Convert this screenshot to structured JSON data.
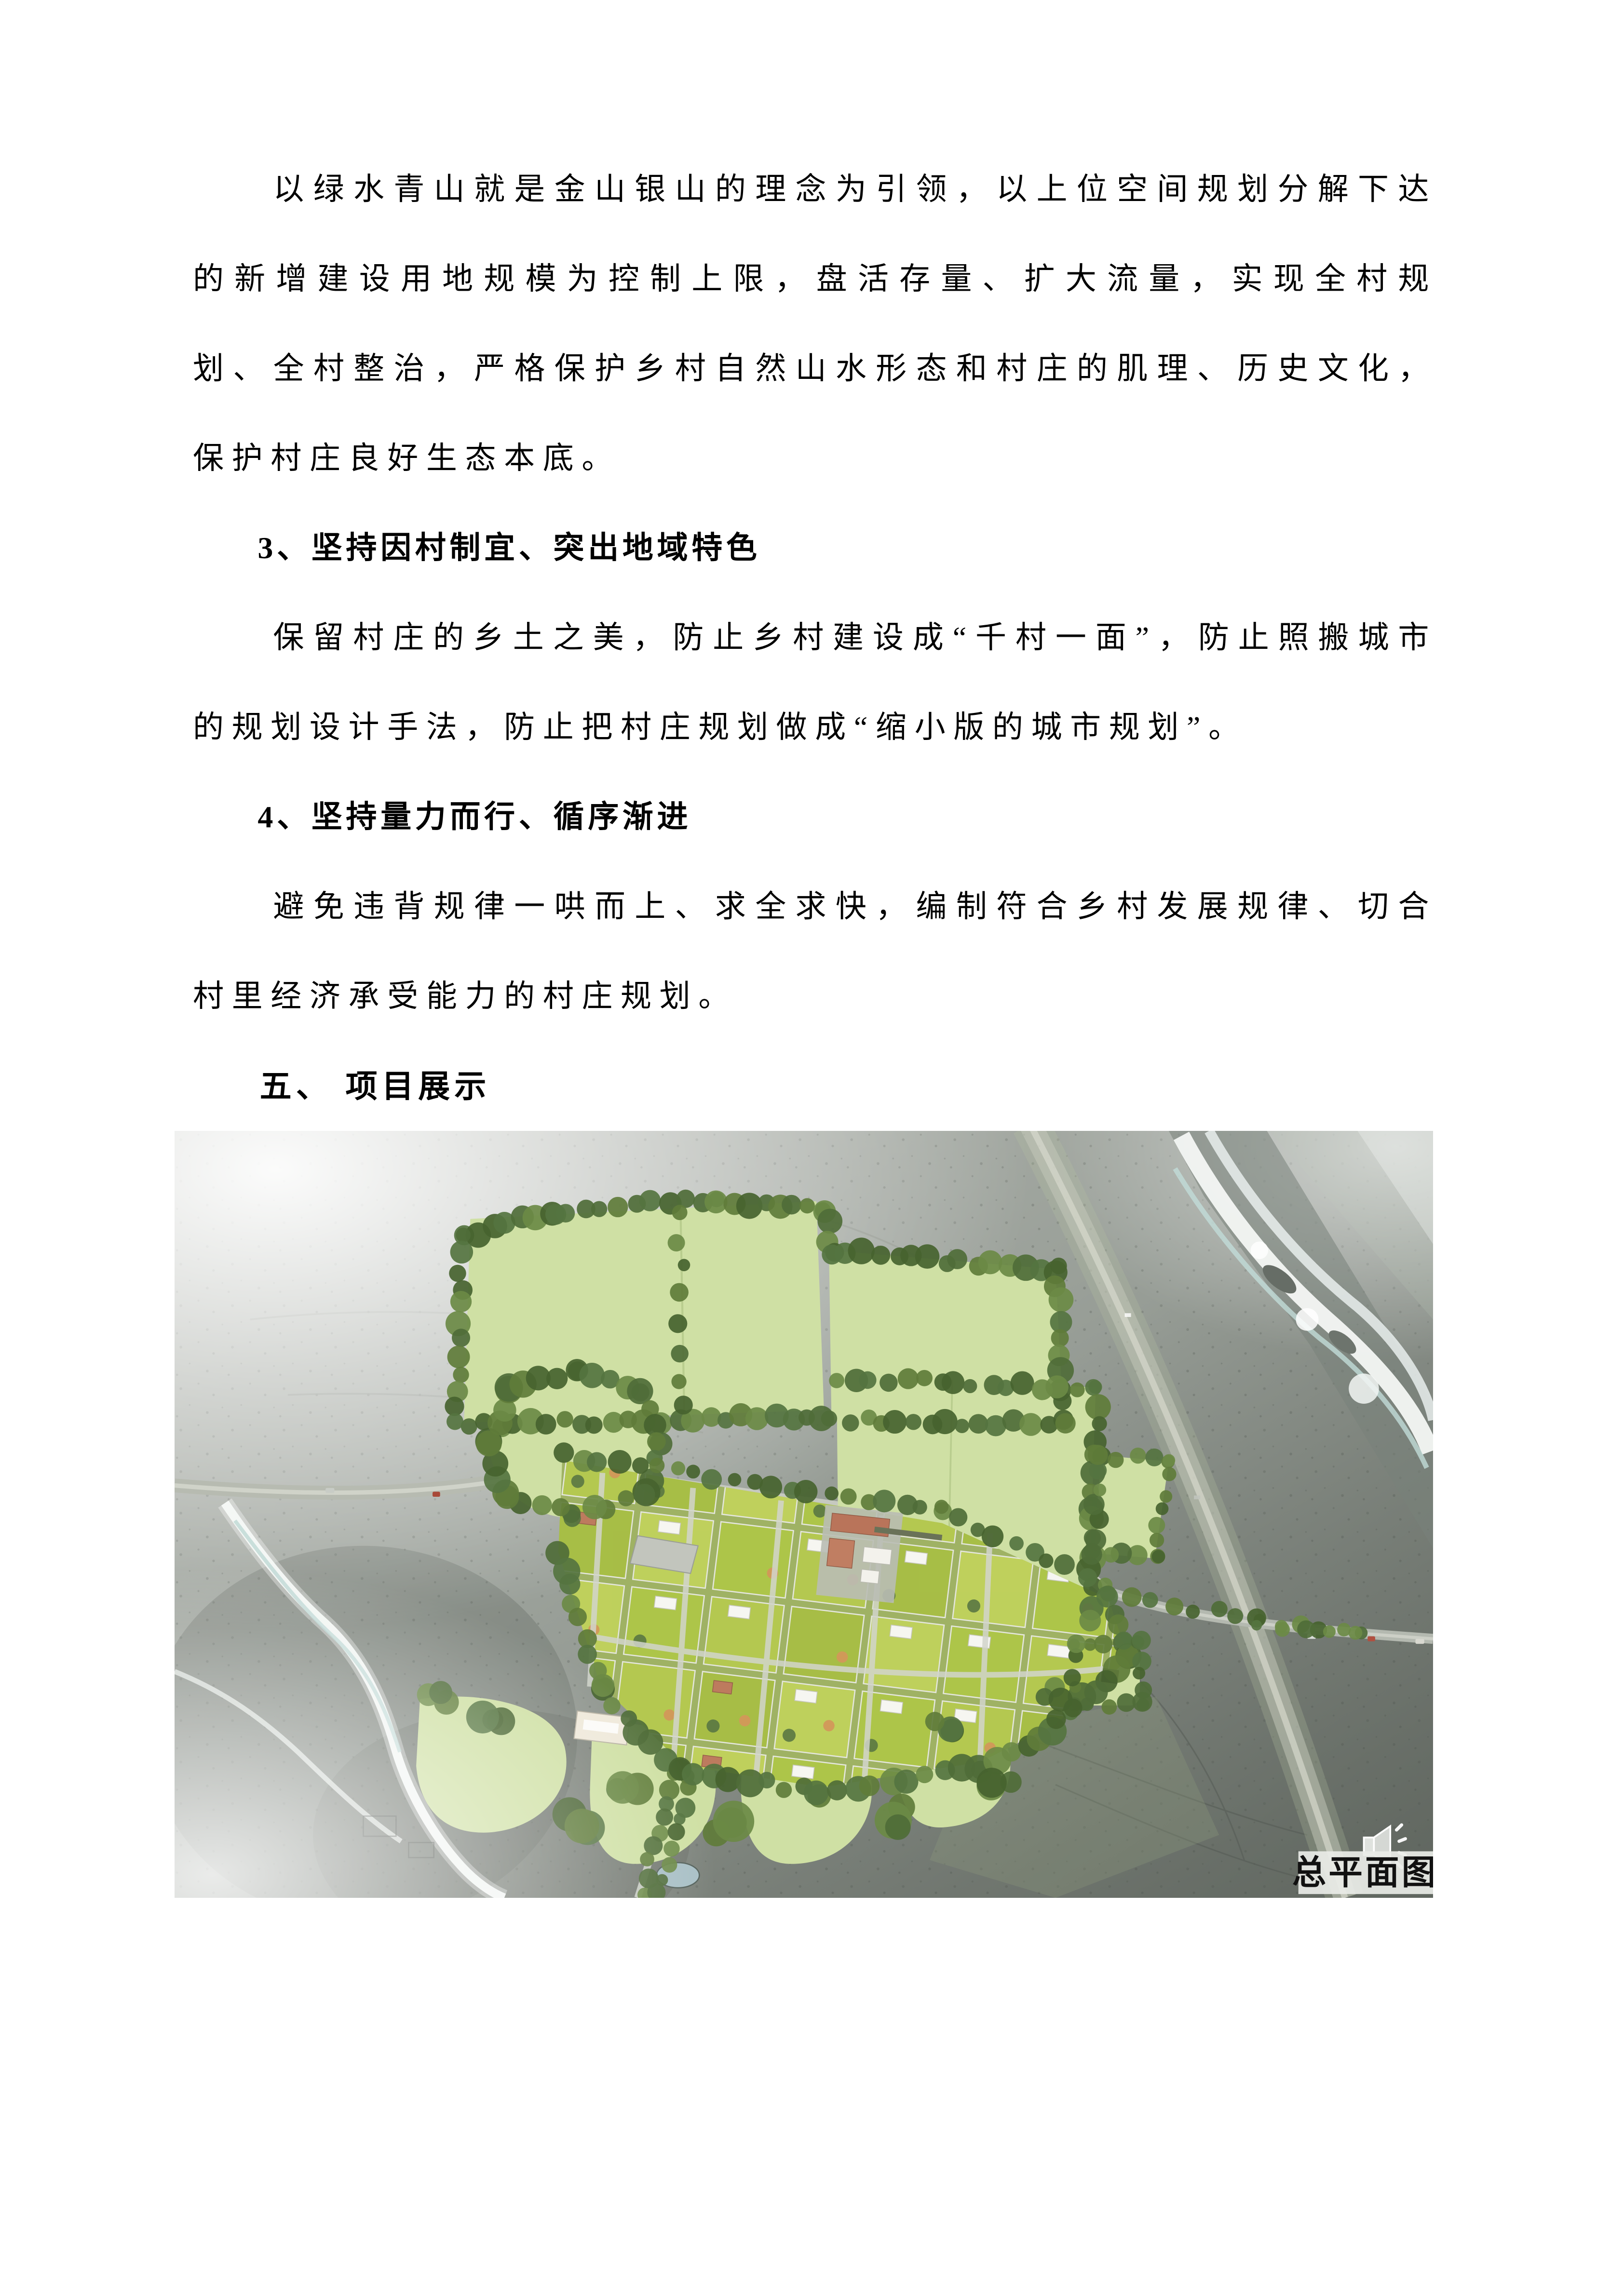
{
  "document": {
    "p1": "以绿水青山就是金山银山的理念为引领，以上位空间规划分解下达的新增建设用地规模为控制上限，盘活存量、扩大流量，实现全村规划、全村整治，严格保护乡村自然山水形态和村庄的肌理、历史文化，保护村庄良好生态本底。",
    "h3": "3、坚持因村制宜、突出地域特色",
    "p3": "保留村庄的乡土之美，防止乡村建设成“千村一面”，防止照搬城市的规划设计手法，防止把村庄规划做成“缩小版的城市规划”。",
    "h4": "4、坚持量力而行、循序渐进",
    "p4": "避免违背规律一哄而上、求全求快，编制符合乡村发展规律、切合村里经济承受能力的村庄规划。",
    "h5": "五、 项目展示"
  },
  "figure": {
    "caption_label": "总平面图",
    "icons": {
      "speaker": "speaker-audio-icon"
    },
    "palette": {
      "terrain_grey": "#9aa099",
      "field_green": "#cfe0a4",
      "parcel_green": "#b5c950",
      "tree_green": "#557440",
      "water_white": "#eef4f2",
      "road_grey": "#c9ccc3",
      "caption_bg": "#e9ebe7",
      "caption_text": "#111111"
    }
  }
}
